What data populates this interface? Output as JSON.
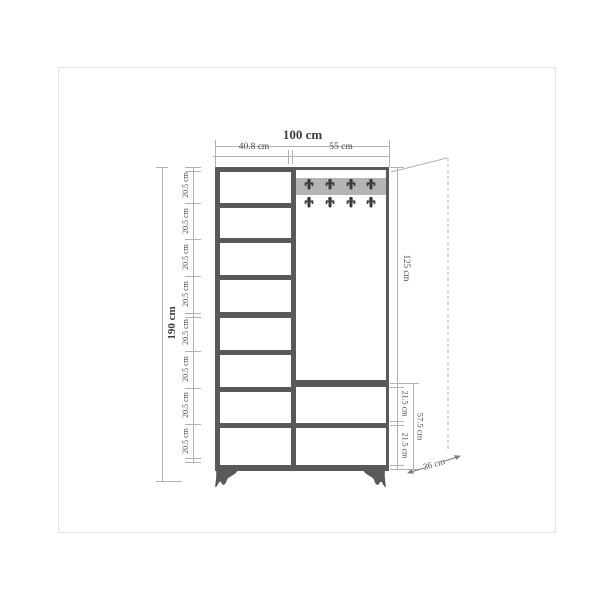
{
  "labels": {
    "total_width": "100 cm",
    "left_column_width": "40.8 cm",
    "right_column_width": "55 cm",
    "total_height": "190 cm",
    "shelf_heights": [
      "20.5 cm",
      "20.5 cm",
      "20.5 cm",
      "20.5 cm",
      "20.5 cm",
      "20.5 cm",
      "20.5 cm",
      "20.5 cm"
    ],
    "upper_right_height": "125 cm",
    "drawer_heights": [
      "21.5 cm",
      "21.5 cm"
    ],
    "drawer_section_height": "57.5 cm",
    "depth": "36 cm"
  },
  "structure": {
    "left_shelf_count": 8,
    "hook_rows": 2,
    "hooks_per_row": 4,
    "drawer_count": 2
  },
  "colors": {
    "outline": "#58595b",
    "hook_band": "#b4b4b4",
    "hook": "#3a3a3c",
    "dimension_line": "#b2b2b2",
    "dimension_text": "#4a4a4b",
    "frame_border": "#e3e3e3"
  }
}
